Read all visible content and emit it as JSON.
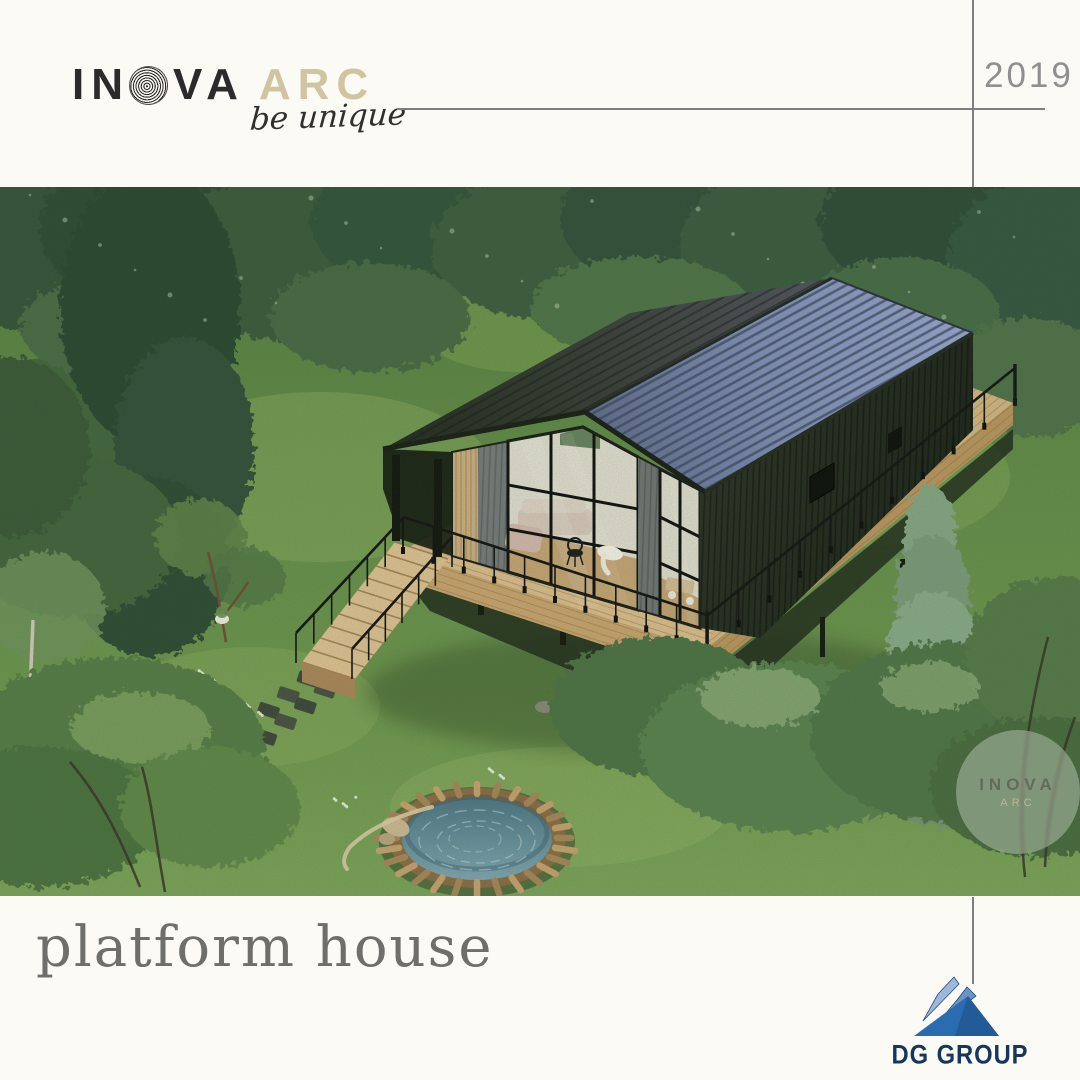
{
  "page": {
    "background": "#fbfaf5",
    "divider_color": "#7e7e7e"
  },
  "header": {
    "logo": {
      "prefix": "IN",
      "middle": "VA",
      "suffix": "ARC",
      "fingerprint_icon": "fingerprint-o",
      "prefix_color": "#2b2b2b",
      "suffix_color": "#d0c5a0"
    },
    "tagline": "be unique",
    "year": "2019"
  },
  "artwork": {
    "subject": "platform house render in forest",
    "watermark": {
      "line1": "INOVA",
      "line2": "ARC"
    }
  },
  "footer": {
    "title": "platform house",
    "partner": {
      "name": "DG GROUP",
      "text_color": "#17365c",
      "triangle_colors": [
        "#9db8dc",
        "#6d94c4",
        "#2a6cb0",
        "#1d4d85"
      ]
    }
  }
}
